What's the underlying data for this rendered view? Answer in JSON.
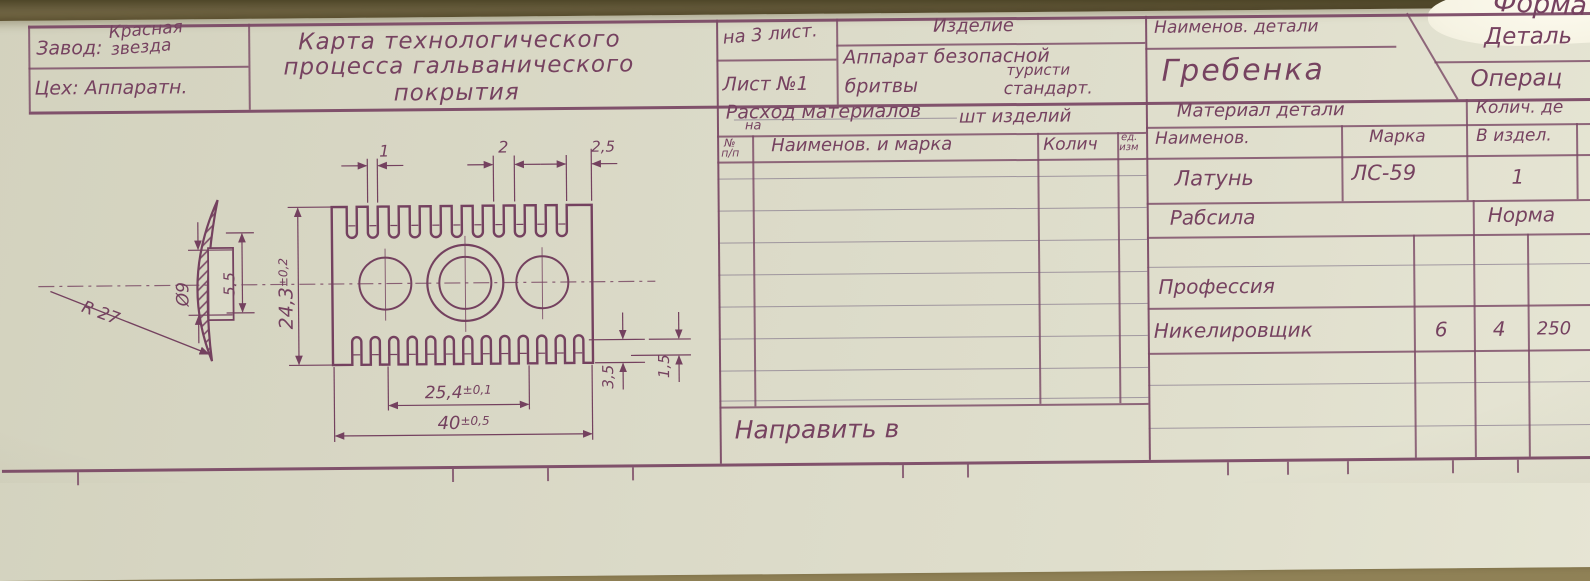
{
  "corner": {
    "form_label": "Форма"
  },
  "header": {
    "factory_label": "Завод:",
    "factory_value_line1": "Красная",
    "factory_value_line2": "звезда",
    "shop": "Цех: Аппаратн.",
    "title_line1": "Карта технологического",
    "title_line2": "процесса гальванического",
    "title_line3": "покрытия",
    "sheets_total": "на 3 лист.",
    "sheet_number": "Лист №1",
    "product_label": "Изделие",
    "product_line1": "Аппарат безопасной",
    "product_line2": "бритвы",
    "product_line3": "туристи",
    "product_line4": "стандарт.",
    "part_label": "Наименов. детали",
    "part_name": "Гребенка",
    "detail_label": "Деталь",
    "operation_label": "Операц"
  },
  "materials": {
    "title": "Расход материалов",
    "title_sub": "на",
    "title_units": "шт изделий",
    "num_top": "№",
    "num_bottom": "п/п",
    "col_name": "Наименов. и марка",
    "col_qty": "Колич",
    "unit_top": "ед.",
    "unit_bottom": "изм",
    "footer": "Направить в"
  },
  "material_info": {
    "header": "Материал детали",
    "qty_header": "Колич. де",
    "col_name": "Наименов.",
    "col_grade": "Марка",
    "col_in_product": "В издел.",
    "name": "Латунь",
    "grade": "ЛС-59",
    "qty": "1"
  },
  "labor": {
    "section": "Рабсила",
    "norm": "Норма",
    "profession_label": "Профессия",
    "profession": "Никелировщик",
    "grade": "6",
    "col_b": "4",
    "col_c": "250"
  },
  "drawing": {
    "dim_slot_width": "1",
    "dim_pitch": "2",
    "dim_margin": "2,5",
    "dim_radius": "R 27",
    "dim_hole": "Ø9",
    "dim_boss": "5,5",
    "dim_height": "24,3",
    "dim_height_tol": "±0,2",
    "dim_inner": "25,4",
    "dim_inner_tol": "±0,1",
    "dim_width": "40",
    "dim_width_tol": "±0,5",
    "dim_teeth_h": "3,5",
    "dim_foot": "1,5"
  }
}
